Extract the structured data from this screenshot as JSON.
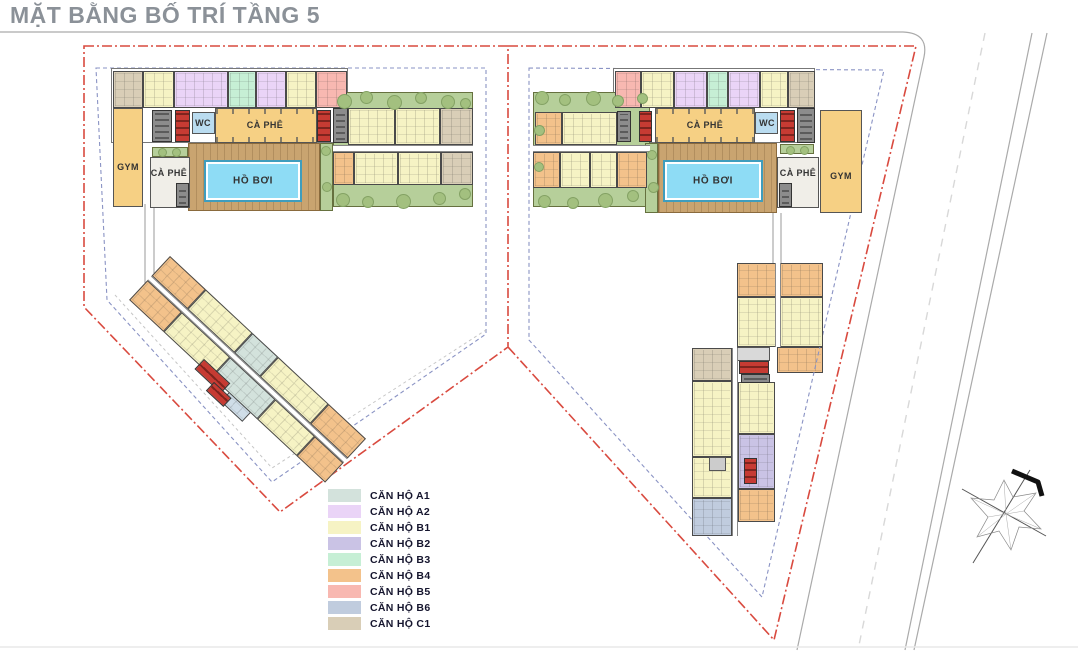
{
  "title": "MẶT BẰNG BỐ TRÍ TẦNG 5",
  "legend": {
    "items": [
      {
        "label": "CĂN HỘ A1",
        "color": "#d3e2dc"
      },
      {
        "label": "CĂN HỘ A2",
        "color": "#ead4f7"
      },
      {
        "label": "CĂN HỘ B1",
        "color": "#f6f3c4"
      },
      {
        "label": "CĂN HỘ B2",
        "color": "#cac3e5"
      },
      {
        "label": "CĂN HỘ B3",
        "color": "#c6efd5"
      },
      {
        "label": "CĂN HỘ B4",
        "color": "#f3c28b"
      },
      {
        "label": "CĂN HỘ B5",
        "color": "#f8b8b1"
      },
      {
        "label": "CĂN HỘ B6",
        "color": "#c0ccde"
      },
      {
        "label": "CĂN HỘ C1",
        "color": "#d9ceb7"
      }
    ]
  },
  "palette": {
    "boundary": "#d94a3f",
    "setback": "#8a93c4",
    "road": "#aaaaaa",
    "roadDash": "#d8d8d8",
    "wall": "#4a4a4a",
    "deck": "#c9a470",
    "pool": "#8edcf5",
    "poolEdge": "#3f9dbd",
    "garden": "#b6cf9a",
    "tree": "#a3c07f",
    "amenity": "#f6d084",
    "wc": "#badcf0",
    "core": "#c63b33",
    "coreDark": "#8c8c8c",
    "title": "#8b9198",
    "legendText": "#15152e",
    "roomLabel": "#333333",
    "corridor": "#ffffff",
    "innerRoom": "#f0eee8"
  },
  "blocks": {
    "left": {
      "gym": "GYM",
      "cafe_inner": "CÀ PHÊ",
      "cafe_main": "CÀ PHÊ",
      "wc": "WC",
      "pool": "HỒ BƠI"
    },
    "right": {
      "gym": "GYM",
      "cafe_inner": "CÀ PHÊ",
      "cafe_main": "CÀ PHÊ",
      "wc": "WC",
      "pool": "HỒ BƠI"
    }
  },
  "units": {
    "left_top": [
      {
        "color": "#d9ceb7",
        "w": 30
      },
      {
        "color": "#f6f3c4",
        "w": 30
      },
      {
        "color": "#ead4f7",
        "w": 55
      },
      {
        "color": "#c6efd5",
        "w": 28
      },
      {
        "color": "#ead4f7",
        "w": 30
      },
      {
        "color": "#f6f3c4",
        "w": 29
      },
      {
        "color": "#f8b8b1",
        "w": 31
      }
    ],
    "right_top": [
      {
        "color": "#f8b8b1",
        "w": 26
      },
      {
        "color": "#f6f3c4",
        "w": 33
      },
      {
        "color": "#ead4f7",
        "w": 34
      },
      {
        "color": "#c6efd5",
        "w": 20
      },
      {
        "color": "#ead4f7",
        "w": 33
      },
      {
        "color": "#f6f3c4",
        "w": 28
      },
      {
        "color": "#d9ceb7",
        "w": 27
      }
    ],
    "left_garden_top": [
      {
        "color": "#f6f3c4",
        "w": 47
      },
      {
        "color": "#f6f3c4",
        "w": 45
      },
      {
        "color": "#d9ceb7",
        "w": 33
      }
    ],
    "left_garden_bottom": [
      {
        "color": "#f3c28b",
        "w": 20
      },
      {
        "color": "#f6f3c4",
        "w": 45
      },
      {
        "color": "#f6f3c4",
        "w": 43
      },
      {
        "color": "#d9ceb7",
        "w": 32
      }
    ],
    "right_garden_top": [
      {
        "color": "#f3c28b",
        "w": 27
      },
      {
        "color": "#f6f3c4",
        "w": 57
      }
    ],
    "right_garden_bottom": [
      {
        "color": "#f3c28b",
        "w": 27
      },
      {
        "color": "#f6f3c4",
        "w": 30
      },
      {
        "color": "#f6f3c4",
        "w": 27
      },
      {
        "color": "#f3c28b",
        "w": 30
      }
    ],
    "left_wing_row1": [
      {
        "color": "#f3c28b",
        "w": 42
      },
      {
        "color": "#f6f3c4",
        "w": 56
      },
      {
        "color": "#d3e2dc",
        "w": 30
      },
      {
        "color": "#f6f3c4",
        "w": 60
      },
      {
        "color": "#f3c28b",
        "w": 44
      }
    ],
    "left_wing_row2": [
      {
        "color": "#f3c28b",
        "w": 44
      },
      {
        "color": "#f6f3c4",
        "w": 62
      },
      {
        "color": "#d3e2dc",
        "w": 58
      },
      {
        "color": "#f6f3c4",
        "w": 50
      },
      {
        "color": "#f3c28b",
        "w": 36
      }
    ],
    "right_wing_head_r1": [
      {
        "color": "#f3c28b",
        "w": 50
      },
      {
        "color": "#f3c28b",
        "w": 50
      }
    ],
    "right_wing_head_r2": [
      {
        "color": "#f6f3c4",
        "w": 50
      },
      {
        "color": "#f6f3c4",
        "w": 50
      }
    ],
    "right_wing_col_left": [
      {
        "color": "#d9ceb7",
        "w": 32
      },
      {
        "color": "#f6f3c4",
        "w": 78
      },
      {
        "color": "#f6f3c4",
        "w": 40
      },
      {
        "color": "#c0ccde",
        "w": 38
      }
    ],
    "right_wing_col_right": [
      {
        "color": "#f6f3c4",
        "w": 52
      },
      {
        "color": "#cac3e5",
        "w": 56
      },
      {
        "color": "#f3c28b",
        "w": 32
      }
    ]
  }
}
